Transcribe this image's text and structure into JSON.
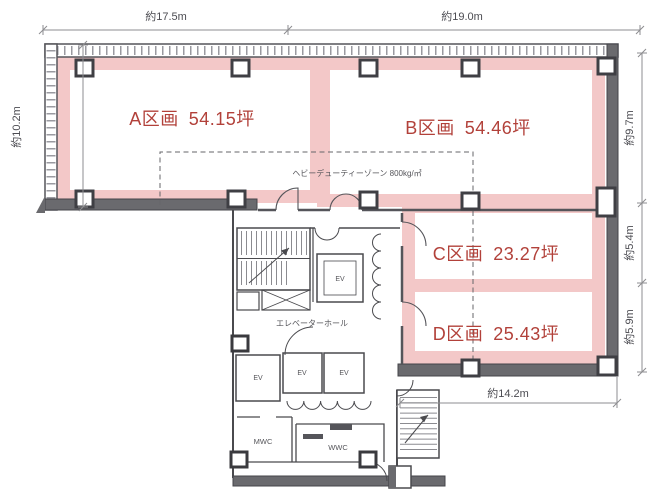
{
  "plan": {
    "type": "office-floor-plan",
    "colors": {
      "highlight_pink": "#f3c8c8",
      "section_label_red": "#b2413a",
      "wall_dark": "#4a4a4e",
      "wall_fill": "#6a6a6e",
      "dim_gray": "#4c4c52"
    },
    "dimensions": {
      "top_left": "約17.5m",
      "top_right": "約19.0m",
      "left": "約10.2m",
      "right_upper": "約9.7m",
      "right_middle": "約5.4m",
      "right_lower": "約5.9m",
      "bottom": "約14.2m"
    },
    "sections": {
      "a": {
        "name": "A区画",
        "area": "54.15坪"
      },
      "b": {
        "name": "B区画",
        "area": "54.46坪"
      },
      "c": {
        "name": "C区画",
        "area": "23.27坪"
      },
      "d": {
        "name": "D区画",
        "area": "25.43坪"
      }
    },
    "labels": {
      "heavy_duty": "ヘビーデューティーゾーン 800kg/㎡",
      "elevator_hall": "エレベーターホール",
      "ev": "EV",
      "mwc": "MWC",
      "wwc": "WWC"
    }
  }
}
